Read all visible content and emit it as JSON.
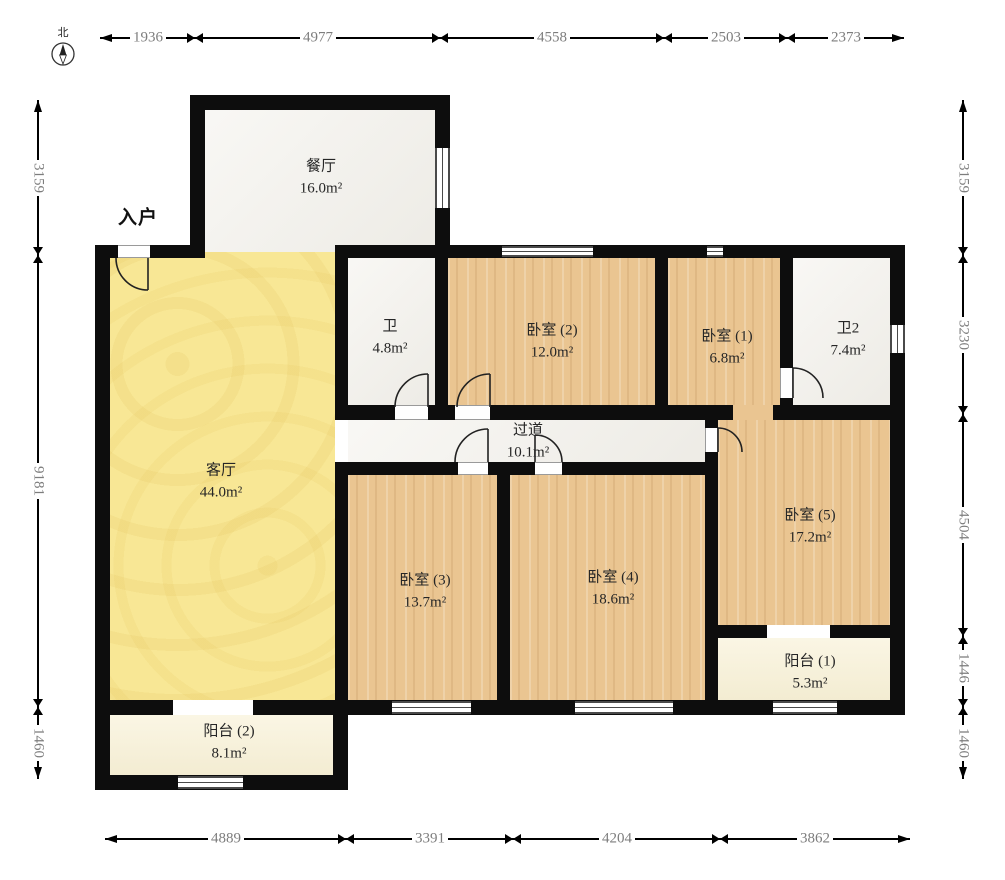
{
  "compass": {
    "north_label": "北"
  },
  "entrance": {
    "label": "入户"
  },
  "rooms": {
    "dining": {
      "name": "餐厅",
      "area": "16.0m²"
    },
    "living": {
      "name": "客厅",
      "area": "44.0m²"
    },
    "bath1": {
      "name": "卫",
      "area": "4.8m²"
    },
    "bedroom2": {
      "name": "卧室 (2)",
      "area": "12.0m²"
    },
    "bedroom1": {
      "name": "卧室 (1)",
      "area": "6.8m²"
    },
    "bath2": {
      "name": "卫2",
      "area": "7.4m²"
    },
    "hallway": {
      "name": "过道",
      "area": "10.1m²"
    },
    "bedroom5": {
      "name": "卧室 (5)",
      "area": "17.2m²"
    },
    "bedroom3": {
      "name": "卧室 (3)",
      "area": "13.7m²"
    },
    "bedroom4": {
      "name": "卧室 (4)",
      "area": "18.6m²"
    },
    "balcony1": {
      "name": "阳台 (1)",
      "area": "5.3m²"
    },
    "balcony2": {
      "name": "阳台 (2)",
      "area": "8.1m²"
    }
  },
  "dimensions": {
    "top": [
      "1936",
      "4977",
      "4558",
      "2503",
      "2373"
    ],
    "bottom": [
      "4889",
      "3391",
      "4204",
      "3862"
    ],
    "left": [
      "3159",
      "9181",
      "1460"
    ],
    "right": [
      "3159",
      "3230",
      "4504",
      "1446",
      "1460"
    ]
  },
  "colors": {
    "wall": "#0d0d0d",
    "wood": "#eac591",
    "living": "#f8e795",
    "marble": "#f2f0ea",
    "balcony": "#f8f1d6"
  }
}
